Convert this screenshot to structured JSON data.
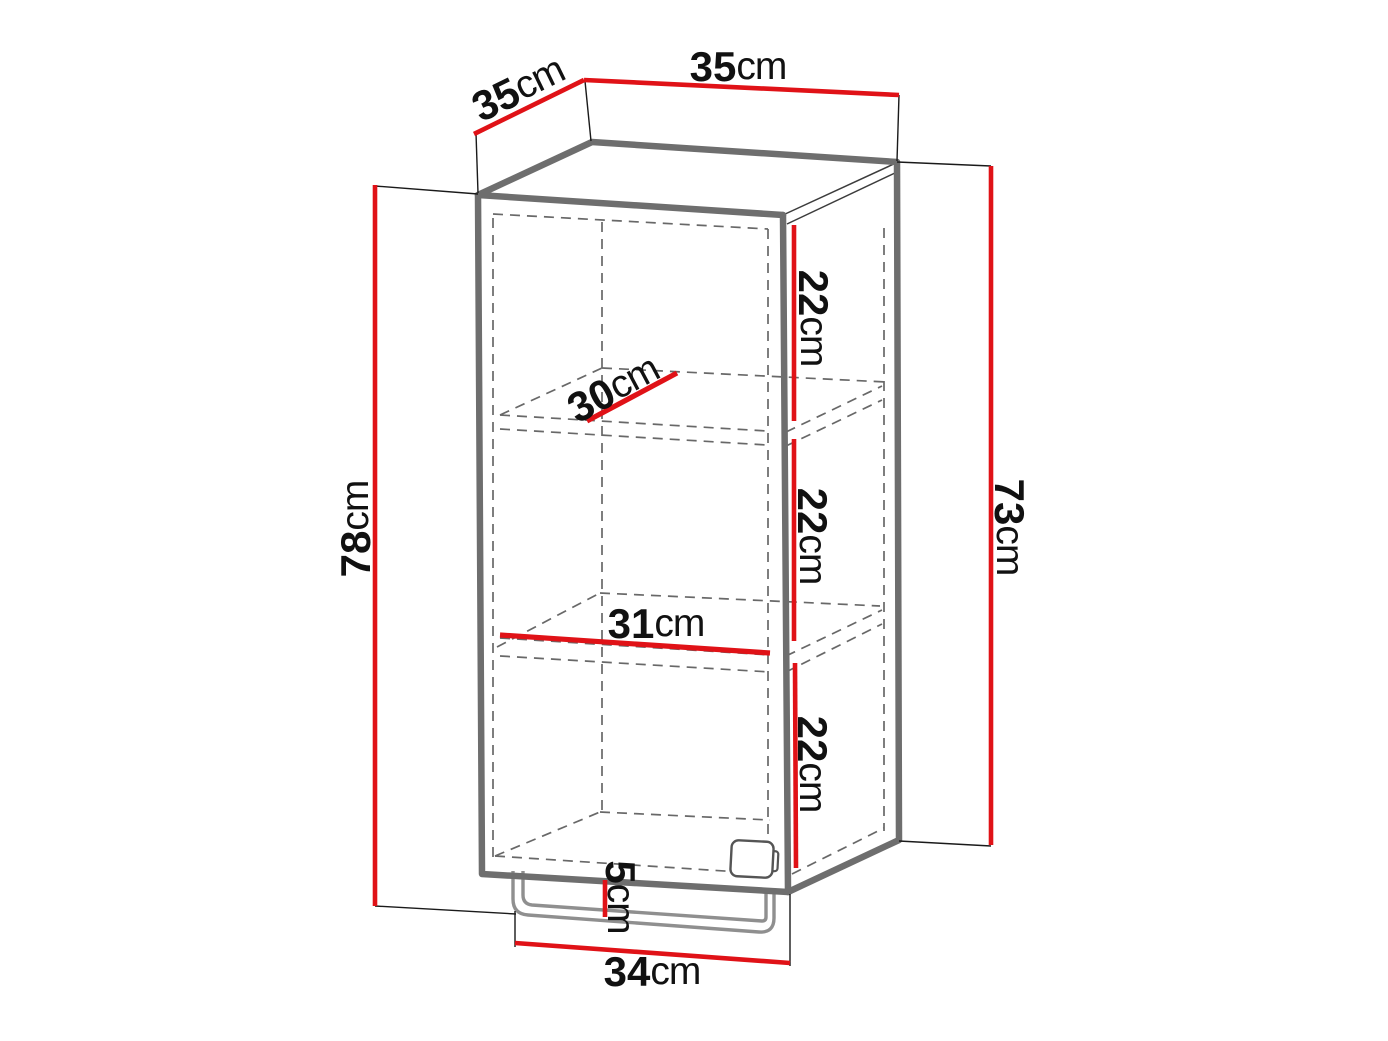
{
  "diagram": {
    "subject": "wall-cabinet-dimension-drawing",
    "description": "Open-front cabinet with two shelves and a bottom rail, annotated with red dimension lines",
    "colors": {
      "dimension_line": "#e01217",
      "cabinet_outline": "#6e6e6e",
      "hidden_edge": "#686868",
      "extension_line": "#1a1a1a",
      "rail_outline": "#8f8f8f",
      "label_text": "#111111",
      "background": "#ffffff"
    },
    "dimensions": {
      "top_width": {
        "value": "35",
        "unit": "cm"
      },
      "top_depth": {
        "value": "35",
        "unit": "cm"
      },
      "overall_height": {
        "value": "78",
        "unit": "cm"
      },
      "carcass_height": {
        "value": "73",
        "unit": "cm"
      },
      "top_section_height": {
        "value": "22",
        "unit": "cm"
      },
      "middle_section_height": {
        "value": "22",
        "unit": "cm"
      },
      "bottom_section_height": {
        "value": "22",
        "unit": "cm"
      },
      "shelf_depth": {
        "value": "30",
        "unit": "cm"
      },
      "shelf_width": {
        "value": "31",
        "unit": "cm"
      },
      "rail_height": {
        "value": "5",
        "unit": "cm"
      },
      "base_width": {
        "value": "34",
        "unit": "cm"
      }
    }
  }
}
